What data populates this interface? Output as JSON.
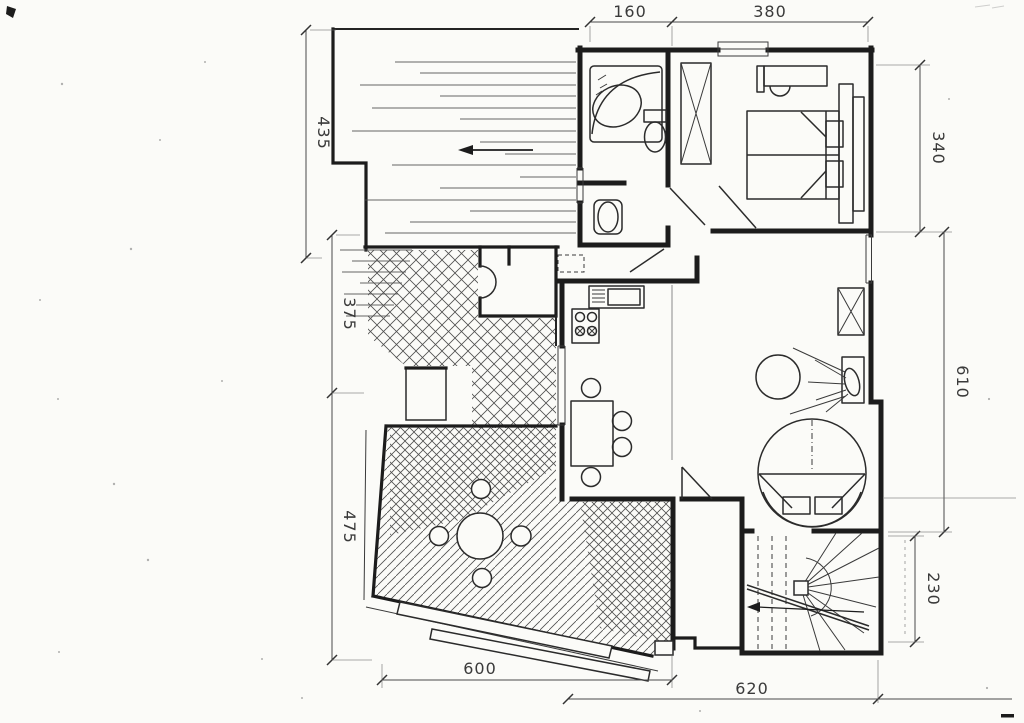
{
  "drawing": {
    "kind": "scanned architectural floor plan",
    "paper_color": "#fbfbf8",
    "ink_color": "#1c1c1c",
    "hatch_color": "#4f4f4f"
  },
  "dimensions": {
    "top": [
      {
        "label": "160"
      },
      {
        "label": "380"
      }
    ],
    "left": [
      {
        "label": "435"
      },
      {
        "label": "375"
      },
      {
        "label": "475"
      }
    ],
    "right": [
      {
        "label": "340"
      },
      {
        "label": "610"
      },
      {
        "label": "230"
      }
    ],
    "bottom": [
      {
        "label": "600"
      },
      {
        "label": "620"
      }
    ]
  },
  "icons": {
    "direction_arrow": "left-arrow",
    "bathtub": "corner-bathtub",
    "toilet": "toilet",
    "washbasin": "washbasin",
    "wardrobe": "crossed-box-wardrobe",
    "bed": "double-bed-with-pillows",
    "desk_chair": "desk-with-chair",
    "kitchen_sink": "sink-counter",
    "stove": "four-burner-stove",
    "dining_table": "table-with-four-chairs",
    "terrace_table": "round-table-with-four-chairs",
    "wall_lamp": "radiating-wall-lamp",
    "sofa": "semicircular-seating",
    "stairs": "winder-staircase-with-arrow",
    "entry_door": "quarter-circle-door-swing"
  }
}
